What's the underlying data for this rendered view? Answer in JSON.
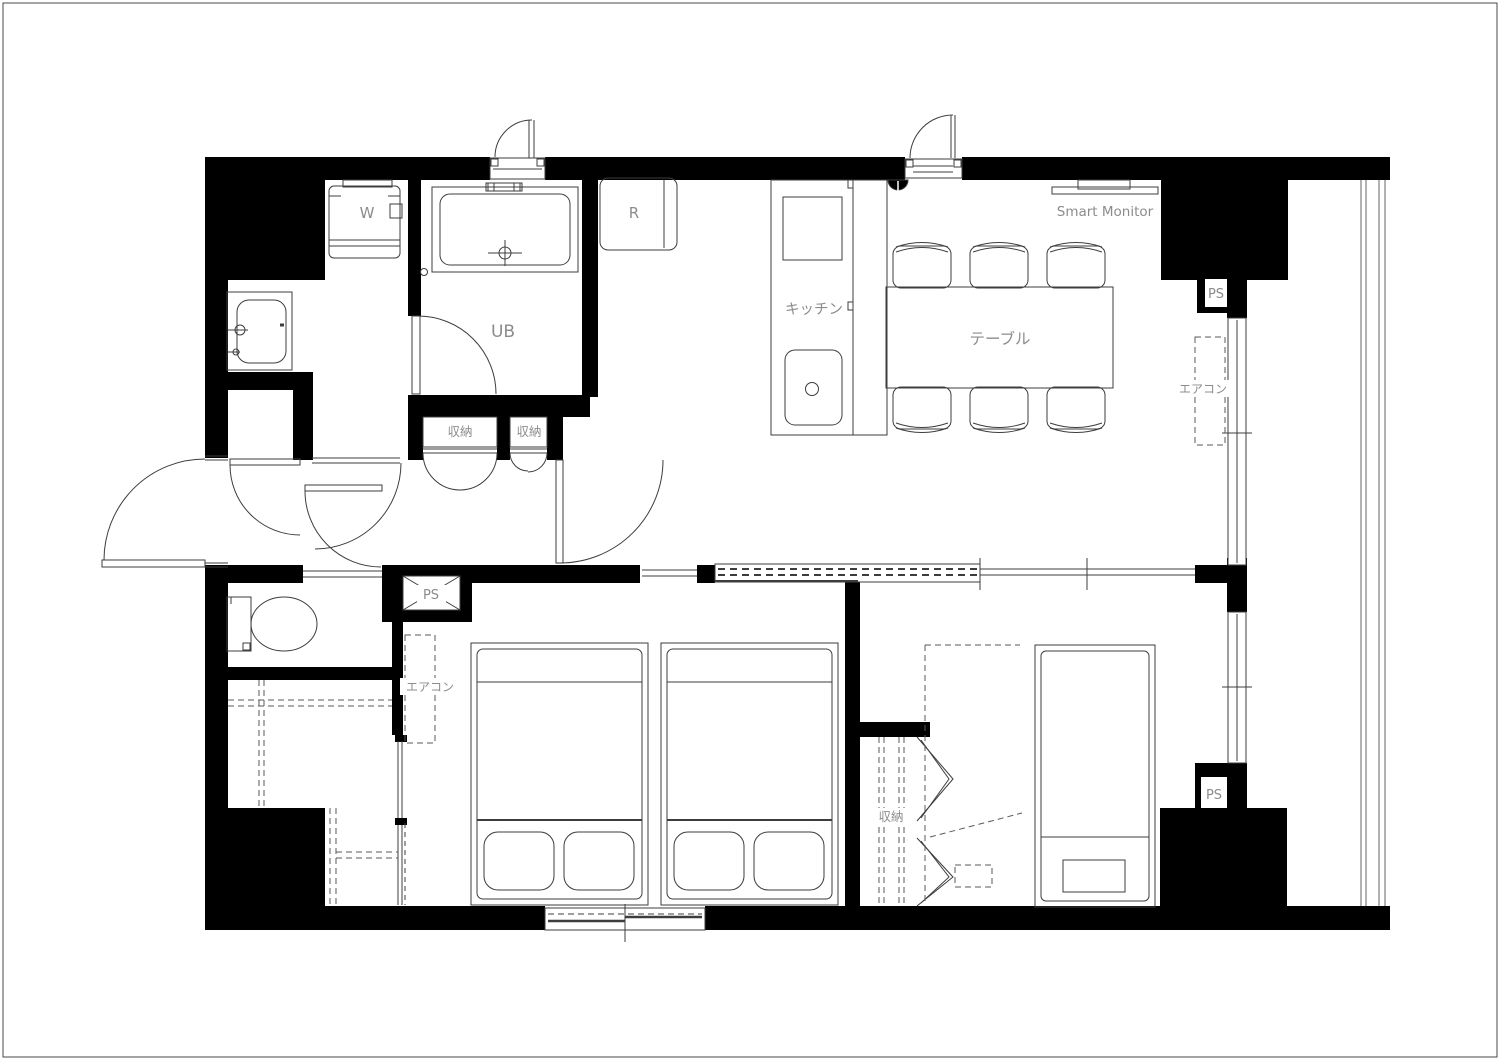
{
  "floorplan": {
    "labels": {
      "washing_machine": "W",
      "refrigerator": "R",
      "unit_bath": "UB",
      "hall_closet_left": "収納",
      "hall_closet_right": "収納",
      "bedroom2_closet": "収納",
      "kitchen": "キッチン",
      "dining_table": "テーブル",
      "smart_monitor": "Smart Monitor",
      "bedroom1_aircon": "エアコン",
      "living_aircon": "エアコン",
      "hall_pipe_space": "PS",
      "upper_right_pipe_space": "PS",
      "lower_right_pipe_space": "PS"
    },
    "colors": {
      "wall": "#000000",
      "line": "#3d3d3d",
      "dashed": "#5a5a5a",
      "label": "#8c8c8c",
      "background": "#ffffff"
    }
  }
}
